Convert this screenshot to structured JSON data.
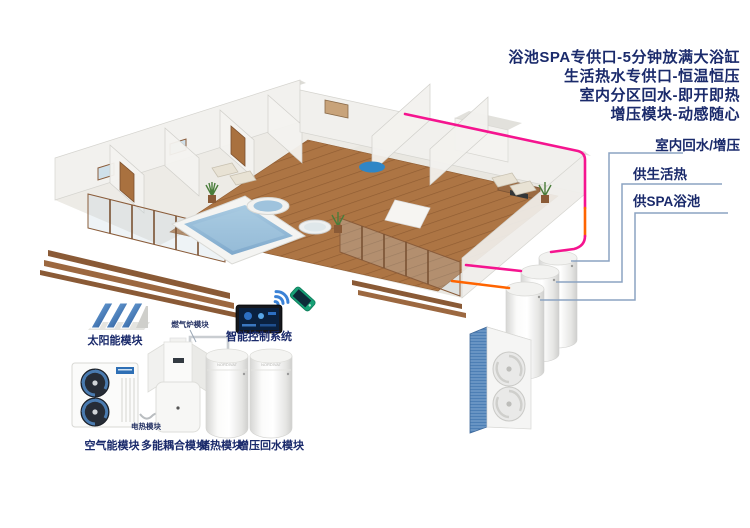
{
  "header": {
    "features": [
      "浴池SPA专供口-5分钟放满大浴缸",
      "生活热水专供口-恒温恒压",
      "室内分区回水-即开即热",
      "增压模块-动感随心"
    ]
  },
  "supply_labels": {
    "indoor_return": "室内回水/增压",
    "domestic_hot": "供生活热",
    "spa_pool": "供SPA浴池"
  },
  "modules": {
    "solar": "太阳能模块",
    "smart_control": "智能控制系统",
    "air_source": "空气能模块",
    "multi_coupling": "多能耦合模块",
    "heat_storage": "储热模块",
    "booster_return": "增压回水模块",
    "gas_furnace": "燃气炉模块",
    "electric_heating": "电热模块"
  },
  "tanks": {
    "brand": "NORDIVAT"
  },
  "colors": {
    "navy_text": "#1a2a6b",
    "pipe_pink": "#f5148f",
    "pipe_orange": "#ff6400",
    "connector_blue": "#8ba3c2",
    "accent_blue": "#2e6fb5",
    "pool_water": "#8fb5d6",
    "deck_wood": "#ad7544"
  }
}
